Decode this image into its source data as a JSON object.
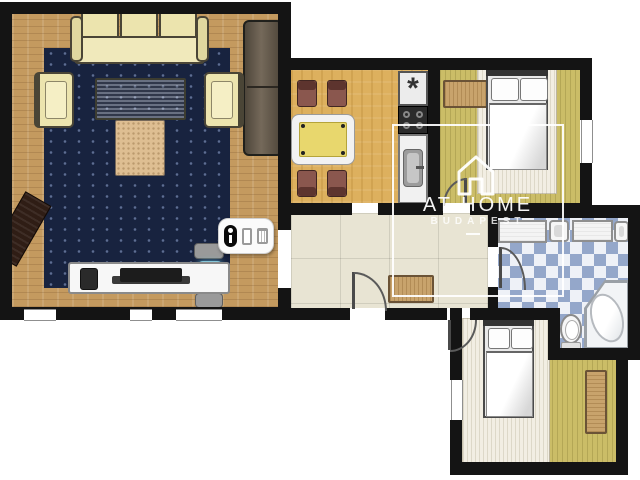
{
  "plan": {
    "type": "apartment-floor-plan",
    "watermark": {
      "title": "AT HOME",
      "subtitle": "BUDAPEST",
      "icon": "house-outline-icon"
    },
    "kitchen": {
      "freezer_symbol": "*"
    },
    "legend_icons": [
      "person-icon",
      "door-icon",
      "trash-icon"
    ],
    "rooms": [
      {
        "name": "living-room",
        "furniture": [
          "three-seat-sofa",
          "chaise-lounge",
          "armchair-left",
          "armchair-right",
          "coffee-table",
          "ottoman",
          "angled-sideboard",
          "tv-console",
          "tv",
          "speaker",
          "office-chair",
          "navy-rug"
        ]
      },
      {
        "name": "dining-room",
        "furniture": [
          "dining-table",
          "dining-chair",
          "dining-chair",
          "dining-chair",
          "dining-chair",
          "fridge-freezer",
          "stove",
          "kitchen-counter",
          "kitchen-sink"
        ]
      },
      {
        "name": "bedroom-top",
        "furniture": [
          "double-bed",
          "dresser",
          "light-rug"
        ]
      },
      {
        "name": "hallway",
        "furniture": [
          "shoe-bench",
          "entry-door"
        ]
      },
      {
        "name": "bathroom",
        "furniture": [
          "vanity-counter",
          "washbasin",
          "vanity-counter",
          "washbasin",
          "toilet",
          "corner-bathtub"
        ]
      },
      {
        "name": "bedroom-bottom",
        "furniture": [
          "double-bed",
          "wardrobe",
          "light-rug"
        ]
      }
    ],
    "colors": {
      "wall": "#141414",
      "living_floor": "#c49a5f",
      "dining_floor": "#ddb05e",
      "bedroom_floor": "#cbbd67",
      "hall_floor": "#e8e4d3",
      "bath_tile_blue": "#94a7ca",
      "bath_tile_white": "#eef1f7",
      "rug_navy": "#18233f",
      "rug_light": "#f2eee3",
      "sofa_cream": "#ece4ae",
      "wood": "#c8a36c",
      "chair_brown": "#8a574e",
      "table_top": "#e8d76d",
      "watermark": "#ffffff"
    }
  }
}
